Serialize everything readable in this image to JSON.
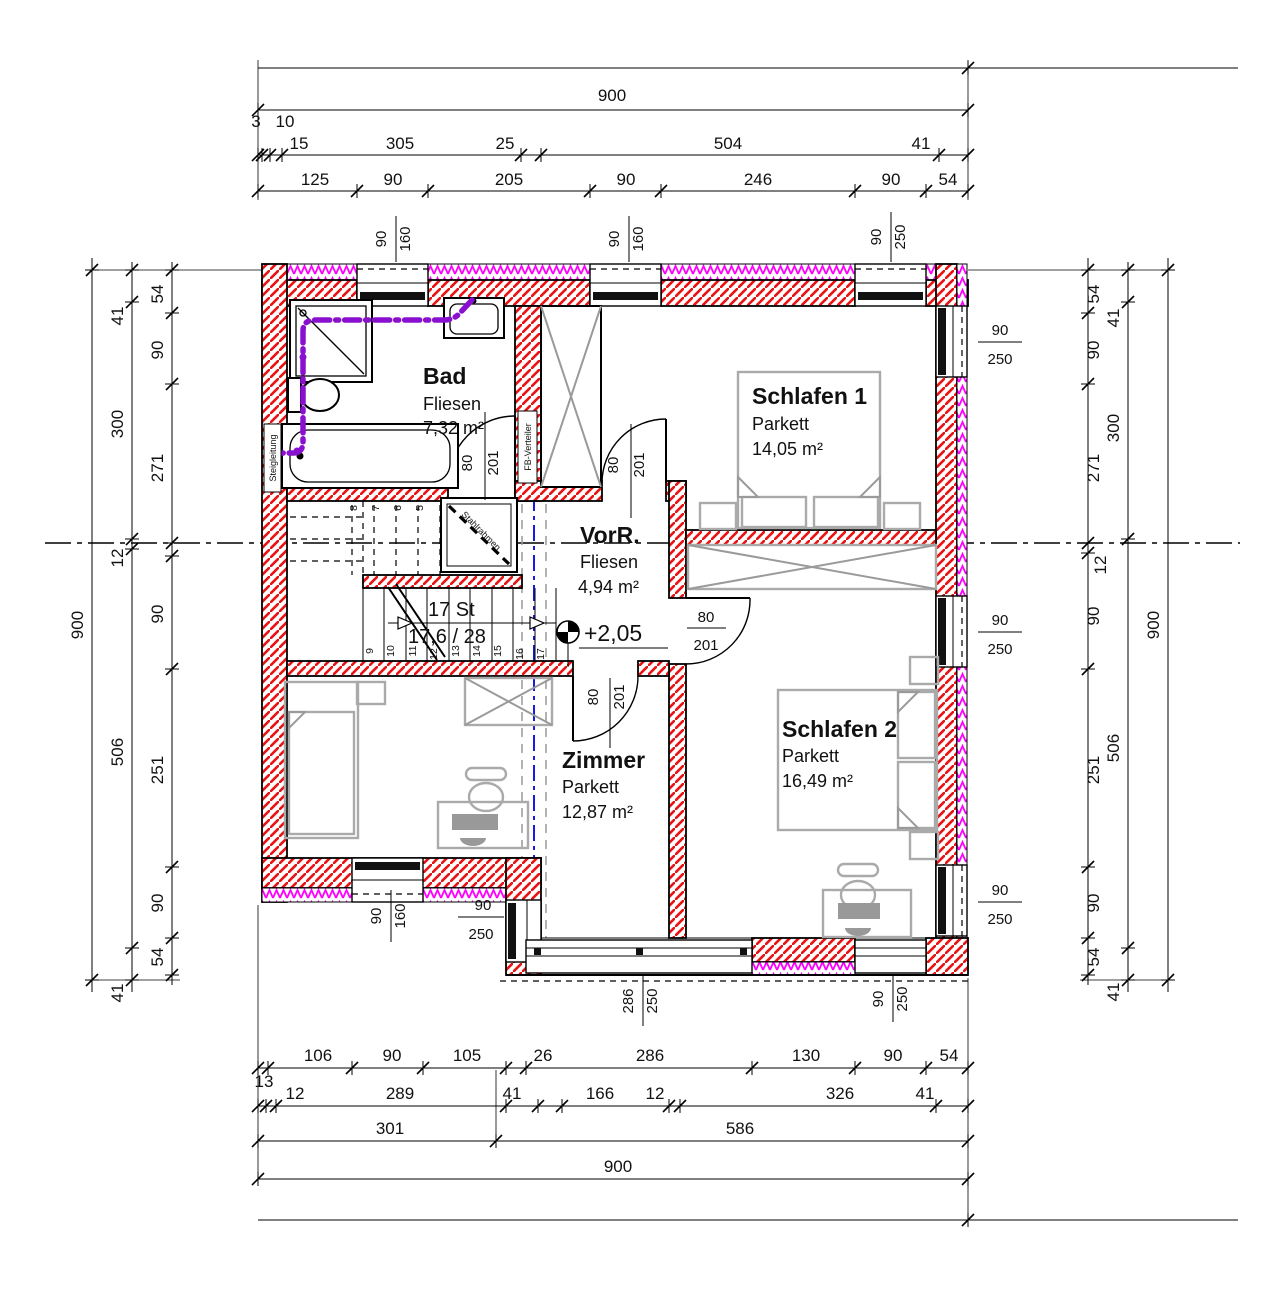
{
  "colors": {
    "wall_hatch": "#e81414",
    "insulation": "#ff00ff",
    "pipe": "#8a10d0",
    "axis_blue": "#1a1ae6",
    "furniture": "#aaaaaa"
  },
  "rooms": [
    {
      "name": "Bad",
      "finish": "Fliesen",
      "area": "7,32 m²"
    },
    {
      "name": "Schlafen 1",
      "finish": "Parkett",
      "area": "14,05 m²"
    },
    {
      "name": "VorR.",
      "finish": "Fliesen",
      "area": "4,94 m²"
    },
    {
      "name": "Zimmer",
      "finish": "Parkett",
      "area": "12,87 m²"
    },
    {
      "name": "Schlafen 2",
      "finish": "Parkett",
      "area": "16,49 m²"
    }
  ],
  "stairs": {
    "count": "17 St",
    "step": "17,6 / 28",
    "steel_frame": "Stahlrahmen",
    "level": "+2,05",
    "steps_upper": [
      "8",
      "7",
      "6",
      "5"
    ],
    "steps_lower": [
      "9",
      "10",
      "11",
      "12",
      "13",
      "14",
      "15",
      "16",
      "17"
    ]
  },
  "labels": {
    "riser": "Steigleitung",
    "fb_distributor": "FB-Verteiler"
  },
  "tags": {
    "door_w": "80",
    "door_h": "201",
    "win_w": "90",
    "win_h_small": "160",
    "win_h_tall": "250",
    "win_wide_w": "286",
    "win_wide_h": "250"
  },
  "dims": {
    "top": {
      "overall": "900",
      "chain1": [
        "3",
        "10",
        "15",
        "305",
        "25",
        "504",
        "41"
      ],
      "chain2": [
        "125",
        "90",
        "205",
        "90",
        "246",
        "90",
        "54"
      ]
    },
    "bottom": {
      "lead": "13",
      "chain1": [
        "106",
        "90",
        "105",
        "26",
        "286",
        "130",
        "90",
        "54"
      ],
      "chain2": [
        "12",
        "289",
        "41",
        "166",
        "12",
        "326",
        "41"
      ],
      "chain3": [
        "301",
        "586"
      ],
      "overall": "900"
    },
    "left": {
      "overall": "900",
      "mid": [
        "41",
        "300",
        "12",
        "506",
        "41"
      ],
      "inner": [
        "54",
        "90",
        "271",
        "90",
        "251",
        "90",
        "54"
      ]
    },
    "right": {
      "overall": "900",
      "mid": [
        "41",
        "300",
        "506",
        "41"
      ],
      "inner": [
        "54",
        "90",
        "271",
        "12",
        "90",
        "251",
        "90",
        "54"
      ]
    }
  }
}
